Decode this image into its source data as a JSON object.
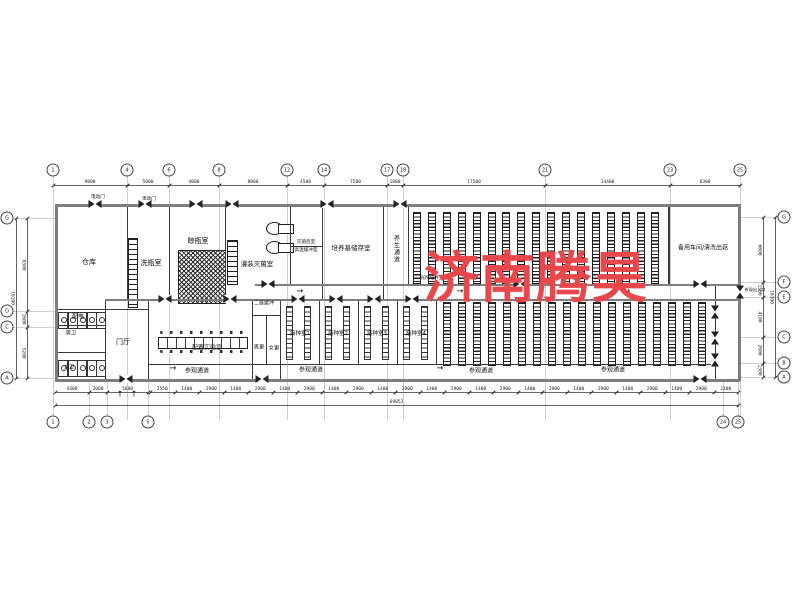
{
  "watermark": {
    "text": "济南腾昊",
    "color": "#e9474b"
  },
  "rooms": {
    "warehouse": "仓库",
    "bottle_washing": "洗瓶室",
    "bottle_drying": "晾瓶室",
    "filling_sterilization": "灌装灭菌室",
    "post_sterilization": "灭菌后室",
    "high_temp_buffer": "高温缓冲室",
    "medium_storage": "培养基储存室",
    "cultivation_corridor": "养生通道",
    "light_cultivation_a": "光照培养室",
    "light_cultivation_b": "光照培养室",
    "spare_workshop": "备用车间/清洗出菇",
    "power_room": "配电",
    "mens_toilet": "男卫",
    "womens_toilet": "女卫",
    "lobby": "门厅",
    "prep_lab": "配置实验室",
    "secondary_buffer": "二级缓冲",
    "mens_changing": "男更",
    "womens_changing": "女更",
    "inoculation_1": "接种室1",
    "inoculation_2": "接种室2",
    "inoculation_3": "接种室3",
    "inoculation_4": "接种室4",
    "visit_corridor_1": "参观通道",
    "visit_corridor_2": "参观通道",
    "visit_corridor_3": "参观通道",
    "visit_corridor_4": "参观通道",
    "electric_door_1": "电动门",
    "electric_door_2": "电动门",
    "visitor_entrance": "参观出入口"
  },
  "grid": {
    "top": [
      {
        "n": "1",
        "x": 53
      },
      {
        "n": "4",
        "x": 127
      },
      {
        "n": "6",
        "x": 169
      },
      {
        "n": "8",
        "x": 219
      },
      {
        "n": "12",
        "x": 287
      },
      {
        "n": "14",
        "x": 324
      },
      {
        "n": "17",
        "x": 387
      },
      {
        "n": "18",
        "x": 403
      },
      {
        "n": "21",
        "x": 545
      },
      {
        "n": "23",
        "x": 670
      },
      {
        "n": "25",
        "x": 740
      }
    ],
    "bottom": [
      {
        "n": "1",
        "x": 53
      },
      {
        "n": "2",
        "x": 89
      },
      {
        "n": "3",
        "x": 107
      },
      {
        "n": "5",
        "x": 148
      },
      {
        "n": "24",
        "x": 723
      },
      {
        "n": "25",
        "x": 738
      }
    ],
    "left": [
      {
        "n": "G",
        "y": 218
      },
      {
        "n": "D",
        "y": 311
      },
      {
        "n": "C",
        "y": 327
      },
      {
        "n": "A",
        "y": 378
      }
    ],
    "right": [
      {
        "n": "G",
        "y": 217
      },
      {
        "n": "F",
        "y": 282
      },
      {
        "n": "E",
        "y": 297
      },
      {
        "n": "C",
        "y": 337
      },
      {
        "n": "B",
        "y": 363
      },
      {
        "n": "A",
        "y": 377
      }
    ]
  },
  "dims": {
    "top_y": 185,
    "top": [
      {
        "v": "9800",
        "x1": 53,
        "x2": 127
      },
      {
        "v": "5000",
        "x1": 127,
        "x2": 169
      },
      {
        "v": "4000",
        "x1": 169,
        "x2": 219
      },
      {
        "v": "8000",
        "x1": 219,
        "x2": 287
      },
      {
        "v": "4500",
        "x1": 287,
        "x2": 324
      },
      {
        "v": "7500",
        "x1": 324,
        "x2": 387
      },
      {
        "v": "1800",
        "x1": 387,
        "x2": 403
      },
      {
        "v": "17500",
        "x1": 403,
        "x2": 545
      },
      {
        "v": "14400",
        "x1": 545,
        "x2": 670
      },
      {
        "v": "8300",
        "x1": 670,
        "x2": 740
      }
    ],
    "bottom_small_y": 392,
    "bottom_small_start": 150,
    "bottom_small_end": 738,
    "bottom_small": [
      "2550",
      "1400",
      "2900",
      "1400",
      "2900",
      "1400",
      "2900",
      "1400",
      "2900",
      "1400",
      "2900",
      "1400",
      "2900",
      "1400",
      "2900",
      "1400",
      "2900",
      "1400",
      "2900",
      "1400",
      "2900",
      "1400",
      "2900",
      "2100"
    ],
    "bottom_left": [
      {
        "v": "4300",
        "x1": 55,
        "x2": 89
      },
      {
        "v": "2000",
        "x1": 89,
        "x2": 107
      },
      {
        "v": "5600",
        "x1": 107,
        "x2": 148
      }
    ],
    "bottom_total": {
      "v": "69852",
      "x1": 55,
      "x2": 738,
      "y": 405
    },
    "left": [
      {
        "v": "9300",
        "y1": 218,
        "y2": 311
      },
      {
        "v": "1600",
        "y1": 311,
        "y2": 327
      },
      {
        "v": "5200",
        "y1": 327,
        "y2": 378
      }
    ],
    "left_total": {
      "v": "16100",
      "y1": 218,
      "y2": 378
    },
    "right": [
      {
        "v": "6600",
        "y1": 217,
        "y2": 282
      },
      {
        "v": "1500",
        "y1": 282,
        "y2": 297
      },
      {
        "v": "4100",
        "y1": 297,
        "y2": 337
      },
      {
        "v": "2600",
        "y1": 337,
        "y2": 363
      },
      {
        "v": "1500",
        "y1": 363,
        "y2": 377
      }
    ],
    "right_total": {
      "v": "16300",
      "y1": 217,
      "y2": 377
    }
  },
  "racks": [
    {
      "x": 413,
      "y": 212,
      "count": 17,
      "step": 14.9,
      "w": 6,
      "h": 70
    },
    {
      "x": 443,
      "y": 302,
      "count": 18,
      "step": 15.0,
      "w": 6,
      "h": 62
    }
  ],
  "inoc_rooms": [
    280,
    319,
    358,
    397
  ],
  "doors": [
    {
      "x": 95,
      "y": 204
    },
    {
      "x": 145,
      "y": 204
    },
    {
      "x": 196,
      "y": 204
    },
    {
      "x": 232,
      "y": 204
    },
    {
      "x": 327,
      "y": 204
    },
    {
      "x": 400,
      "y": 204
    },
    {
      "x": 268,
      "y": 284
    },
    {
      "x": 520,
      "y": 284
    },
    {
      "x": 700,
      "y": 284
    },
    {
      "x": 165,
      "y": 299
    },
    {
      "x": 230,
      "y": 299
    },
    {
      "x": 298,
      "y": 299
    },
    {
      "x": 336,
      "y": 299
    },
    {
      "x": 374,
      "y": 299
    },
    {
      "x": 412,
      "y": 299
    },
    {
      "x": 126,
      "y": 379
    },
    {
      "x": 262,
      "y": 379
    },
    {
      "x": 700,
      "y": 379
    },
    {
      "x": 715,
      "y": 312,
      "v": 1
    },
    {
      "x": 715,
      "y": 338,
      "v": 1
    },
    {
      "x": 715,
      "y": 360,
      "v": 1
    },
    {
      "x": 740,
      "y": 292,
      "v": 1
    }
  ],
  "stalls": [
    {
      "x": 58,
      "y": 312,
      "count": 5,
      "gap": 9.5
    },
    {
      "x": 58,
      "y": 360,
      "count": 5,
      "gap": 9.5
    }
  ],
  "arrows": [
    {
      "x": 300,
      "y": 291,
      "t": "→"
    },
    {
      "x": 460,
      "y": 291,
      "t": "→"
    },
    {
      "x": 627,
      "y": 291,
      "t": "→"
    },
    {
      "x": 173,
      "y": 368,
      "t": "→"
    },
    {
      "x": 440,
      "y": 368,
      "t": "→"
    },
    {
      "x": 120,
      "y": 394,
      "t": "↑"
    },
    {
      "x": 134,
      "y": 394,
      "t": "↑"
    }
  ]
}
